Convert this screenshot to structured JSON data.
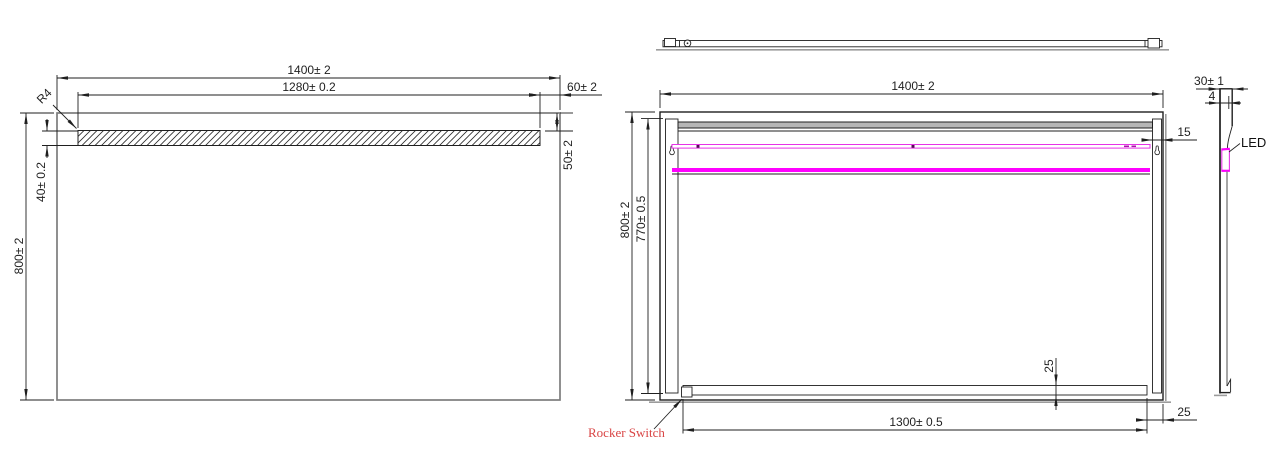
{
  "front_view": {
    "width": "1400± 2",
    "led_window_width": "1280± 0.2",
    "right_offset": "60± 2",
    "right_height": "50± 2",
    "strip_height": "40± 0.2",
    "height": "800± 2",
    "corner_radius": "R4"
  },
  "back_view": {
    "width": "1400± 2",
    "height": "800± 2",
    "rail_height": "770± 0.5",
    "rail_width": "15",
    "bottom_rail_offset": "25",
    "bottom_right_gap": "25",
    "bottom_rail_width": "1300± 0.5",
    "rocker_switch": "Rocker Switch"
  },
  "side_view": {
    "depth": "30± 1",
    "glass_thickness": "4",
    "led": "LED"
  },
  "colors": {
    "line": "#1f1f1f",
    "shadow_gray": "#9c9c9c",
    "led_magenta": "#ff00ff",
    "led_strip_outline": "#e632e6",
    "led_dot": "#550a55",
    "label_red": "#d94545"
  }
}
